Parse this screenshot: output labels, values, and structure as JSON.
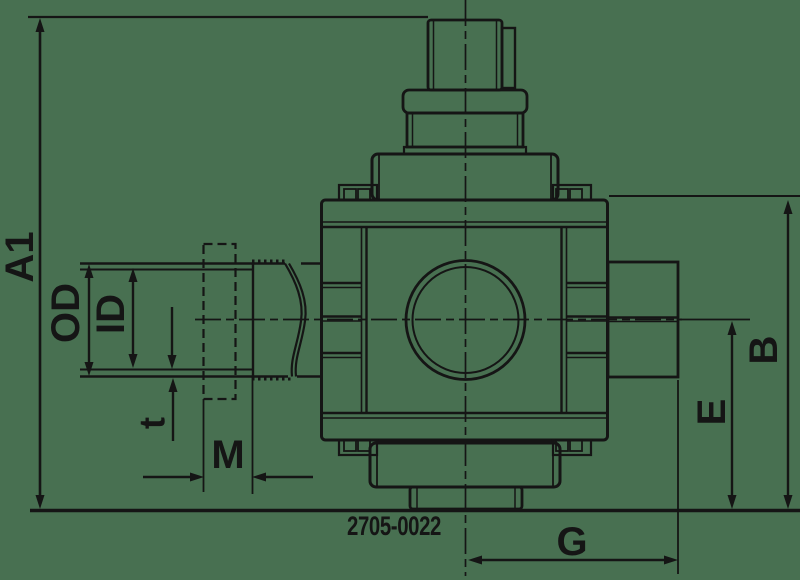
{
  "drawing": {
    "part_number": "2705-0022",
    "labels": {
      "a1": "A1",
      "od": "OD",
      "id": "ID",
      "t": "t",
      "m": "M",
      "g": "G",
      "b": "B",
      "e": "E"
    },
    "colors": {
      "background": "#487051",
      "line": "#151515"
    }
  }
}
